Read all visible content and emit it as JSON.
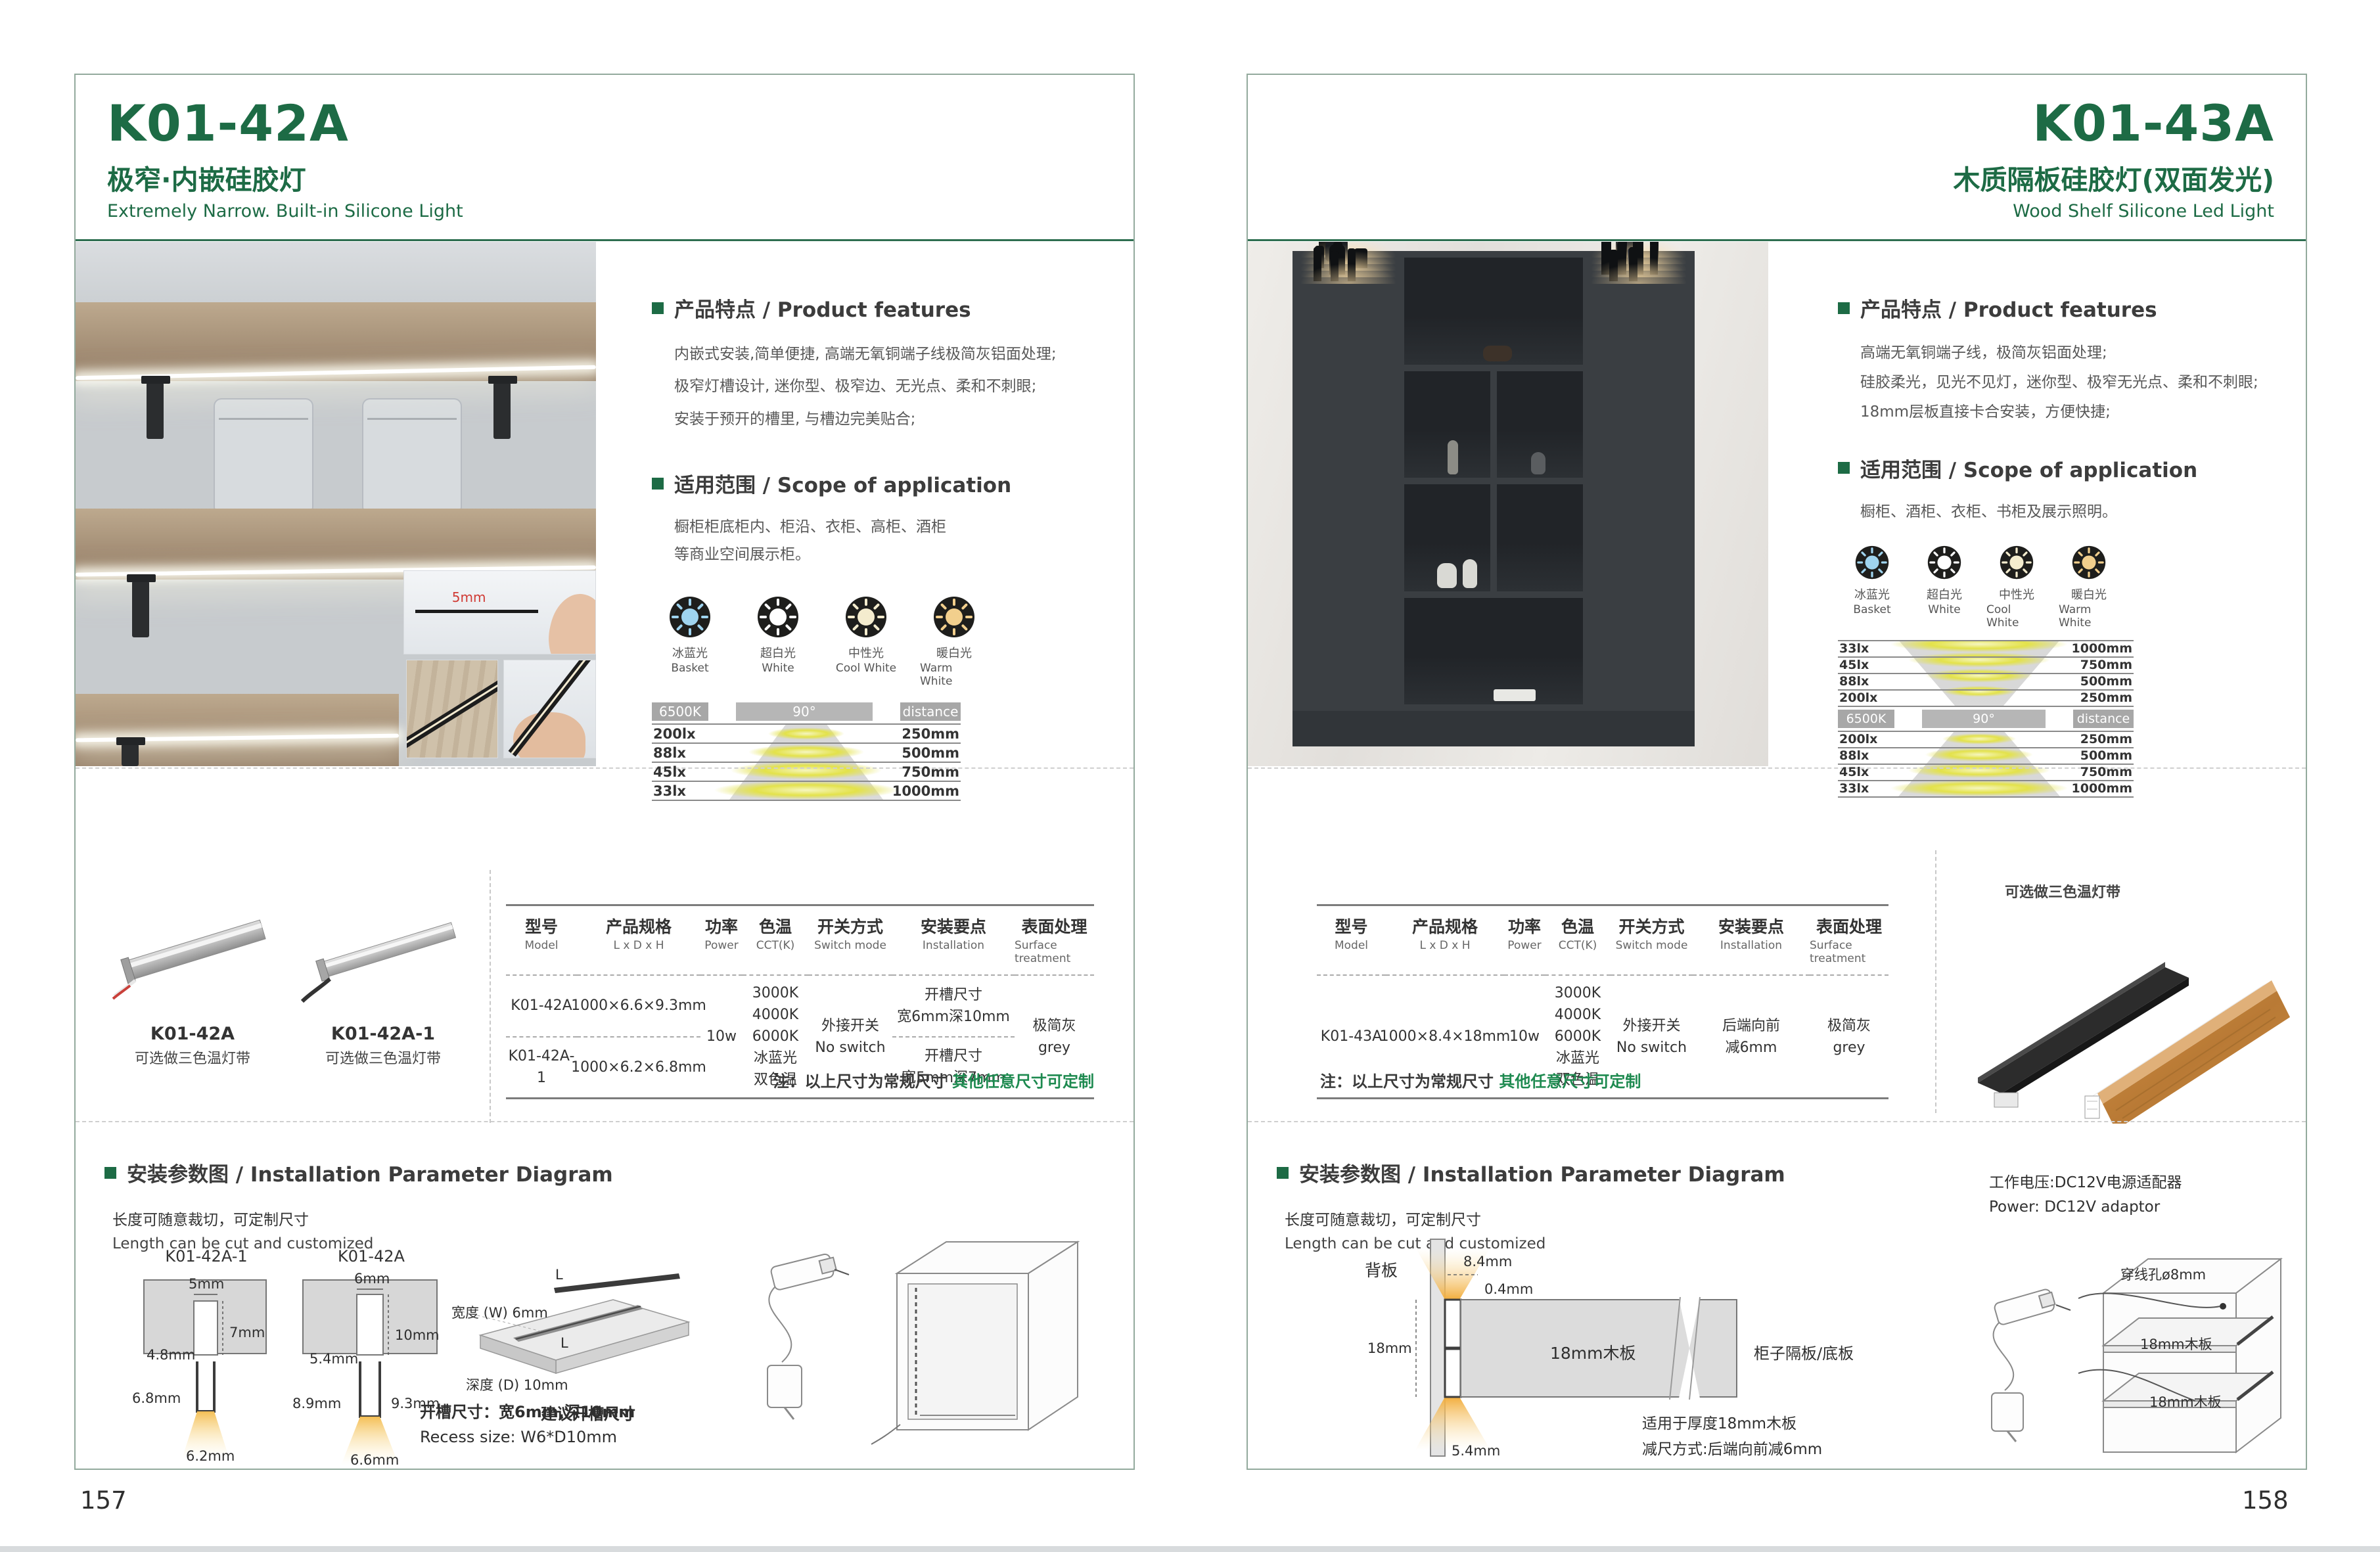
{
  "colors": {
    "accent": "#1d6b45",
    "note_green": "#1e8a50"
  },
  "footer": {
    "left_page_number": "157",
    "right_page_number": "158"
  },
  "shared": {
    "features_heading": "产品特点 / Product features",
    "scope_heading": "适用范围 / Scope of application",
    "install_heading": "安装参数图 / Installation Parameter Diagram",
    "cut_cn": "长度可随意裁切，可定制尺寸",
    "cut_en": "Length can be cut and customized",
    "note_prefix": "注：以上尺寸为常规尺寸 ",
    "note_custom": "其他任意尺寸可定制",
    "light_colors": [
      {
        "cn": "冰蓝光",
        "en": "Basket",
        "color": "#9fd4ef"
      },
      {
        "cn": "超白光",
        "en": "White",
        "color": "#ffffff"
      },
      {
        "cn": "中性光",
        "en": "Cool White",
        "color": "#f4ecce"
      },
      {
        "cn": "暖白光",
        "en": "Warm White",
        "color": "#f2cf8d"
      }
    ],
    "photometry_tags": {
      "cct": "6500K",
      "angle": "90°",
      "distance": "distance"
    },
    "table_headers": [
      {
        "cn": "型号",
        "en": "Model"
      },
      {
        "cn": "产品规格",
        "en": "L x D x H"
      },
      {
        "cn": "功率",
        "en": "Power"
      },
      {
        "cn": "色温",
        "en": "CCT(K)"
      },
      {
        "cn": "开关方式",
        "en": "Switch mode"
      },
      {
        "cn": "安装要点",
        "en": "Installation"
      },
      {
        "cn": "表面处理",
        "en": "Surface treatment"
      }
    ]
  },
  "left": {
    "model": "K01-42A",
    "title_cn": "极窄·内嵌硅胶灯",
    "title_en": "Extremely Narrow. Built-in Silicone Light",
    "features": [
      "内嵌式安装,简单便捷, 高端无氧铜端子线极简灰铝面处理;",
      "极窄灯槽设计, 迷你型、极窄边、无光点、柔和不刺眼;",
      "安装于预开的槽里, 与槽边完美贴合;"
    ],
    "scope": [
      "橱柜柜底柜内、柜沿、衣柜、高柜、酒柜",
      "等商业空间展示柜。"
    ],
    "photometry_rows": [
      {
        "lux": "200lx",
        "dist": "250mm"
      },
      {
        "lux": "88lx",
        "dist": "500mm"
      },
      {
        "lux": "45lx",
        "dist": "750mm"
      },
      {
        "lux": "33lx",
        "dist": "1000mm"
      }
    ],
    "photo_note": "5mm",
    "products": [
      {
        "name": "K01-42A",
        "note": "可选做三色温灯带"
      },
      {
        "name": "K01-42A-1",
        "note": "可选做三色温灯带"
      }
    ],
    "table": {
      "row1": {
        "model": "K01-42A",
        "size": "1000×6.6×9.3mm"
      },
      "row2": {
        "model": "K01-42A-1",
        "size": "1000×6.2×6.8mm"
      },
      "power": "10w",
      "cct": [
        "3000K",
        "4000K",
        "6000K",
        "冰蓝光",
        "双色温"
      ],
      "switch": [
        "外接开关",
        "No switch"
      ],
      "install1": [
        "开槽尺寸",
        "宽6mm深10mm"
      ],
      "install2": [
        "开槽尺寸",
        "宽5mm深7mm"
      ],
      "surface": [
        "极简灰",
        "grey"
      ]
    },
    "diagram1": {
      "label": "K01-42A-1",
      "slot_w": "5mm",
      "slot_d": "7mm",
      "top_w": "4.8mm",
      "height": "6.8mm",
      "bottom_w": "6.2mm"
    },
    "diagram2": {
      "label": "K01-42A",
      "slot_w": "6mm",
      "slot_d": "10mm",
      "top_w": "5.4mm",
      "height_l": "8.9mm",
      "height_r": "9.3mm",
      "bottom_w": "6.6mm"
    },
    "board": {
      "width": "宽度 (W) 6mm",
      "depth": "深度 (D) 10mm",
      "caption": "建议开槽尺寸",
      "l_top": "L",
      "l_mid": "L"
    },
    "recess_cn": "开槽尺寸：宽6mm,深10mm",
    "recess_en": "Recess size: W6*D10mm"
  },
  "right": {
    "model": "K01-43A",
    "title_cn": "木质隔板硅胶灯(双面发光)",
    "title_en": "Wood Shelf Silicone Led Light",
    "features": [
      "高端无氧铜端子线，极简灰铝面处理;",
      "硅胶柔光，见光不见灯，迷你型、极窄无光点、柔和不刺眼;",
      "18mm层板直接卡合安装，方便快捷;"
    ],
    "scope": [
      "橱柜、酒柜、衣柜、书柜及展示照明。"
    ],
    "photometry_rows_top": [
      {
        "lux": "33lx",
        "dist": "1000mm"
      },
      {
        "lux": "45lx",
        "dist": "750mm"
      },
      {
        "lux": "88lx",
        "dist": "500mm"
      },
      {
        "lux": "200lx",
        "dist": "250mm"
      }
    ],
    "photometry_rows_bottom": [
      {
        "lux": "200lx",
        "dist": "250mm"
      },
      {
        "lux": "88lx",
        "dist": "500mm"
      },
      {
        "lux": "45lx",
        "dist": "750mm"
      },
      {
        "lux": "33lx",
        "dist": "1000mm"
      }
    ],
    "product_note": "可选做三色温灯带",
    "table": {
      "row": {
        "model": "K01-43A",
        "size": "1000×8.4×18mm",
        "power": "10w"
      },
      "cct": [
        "3000K",
        "4000K",
        "6000K",
        "冰蓝光",
        "双色温"
      ],
      "switch": [
        "外接开关",
        "No switch"
      ],
      "install": [
        "后端向前",
        "减6mm"
      ],
      "surface": [
        "极简灰",
        "grey"
      ]
    },
    "cross": {
      "back_panel": "背板",
      "d1": "8.4mm",
      "d2": "0.4mm",
      "d3": "18mm",
      "board": "18mm木板",
      "shelf": "柜子隔板/底板",
      "d4": "5.4mm",
      "note1": "适用于厚度18mm木板",
      "note2": "减尺方式:后端向前减6mm"
    },
    "power_cn": "工作电压:DC12V电源适配器",
    "power_en": "Power: DC12V adaptor",
    "cabinet": {
      "hole": "穿线孔ø8mm",
      "shelf1": "18mm木板",
      "shelf2": "18mm木板"
    }
  }
}
